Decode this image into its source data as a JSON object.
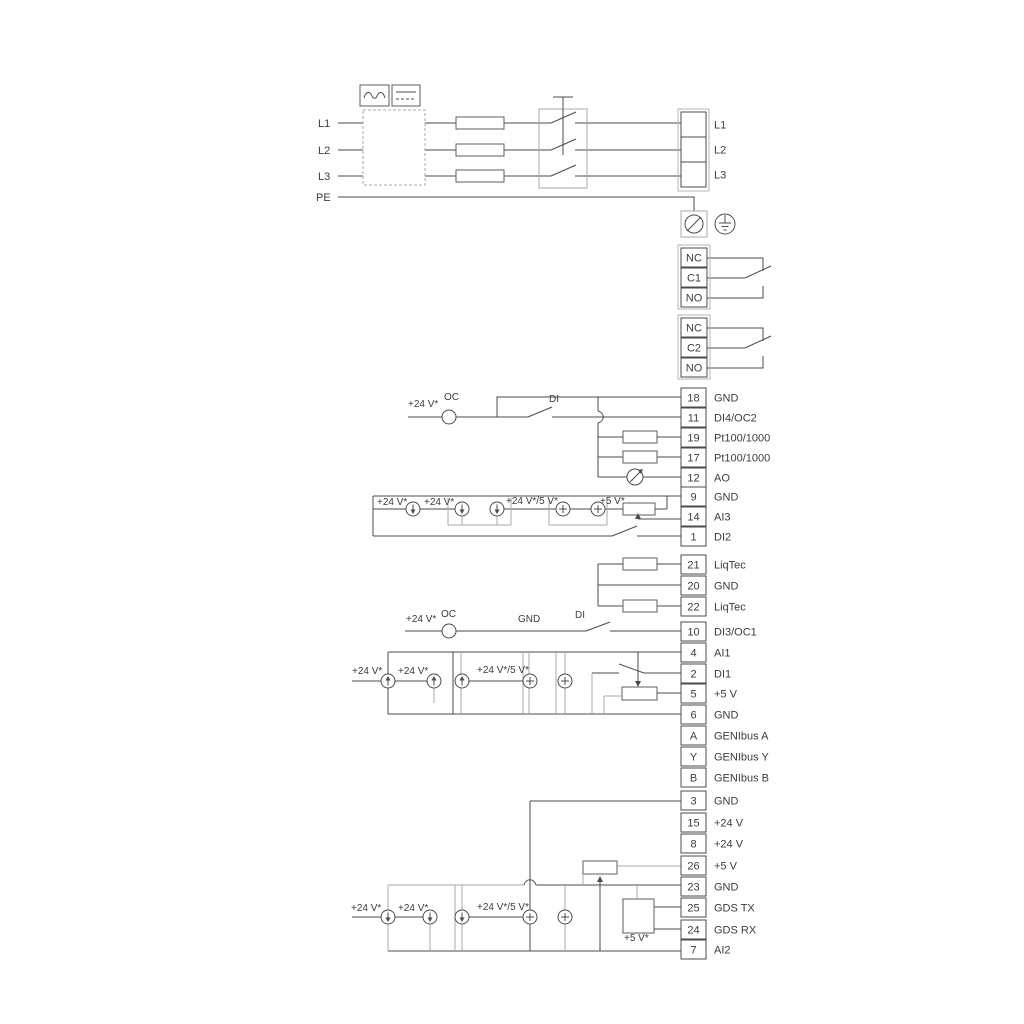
{
  "colors": {
    "wire": "#4b4b4b",
    "alt_wire": "#a8a8a8",
    "text": "#3c3c3c",
    "background": "#ffffff"
  },
  "power": {
    "left_labels": [
      {
        "t": "L1",
        "x": 318,
        "y": 127
      },
      {
        "t": "L2",
        "x": 318,
        "y": 154
      },
      {
        "t": "L3",
        "x": 318,
        "y": 180
      },
      {
        "t": "PE",
        "x": 316,
        "y": 201
      }
    ]
  },
  "terminal_groups": [
    {
      "name": "mains-out",
      "x": 681,
      "w": 25,
      "h": 25,
      "frame": [
        678,
        109,
        31,
        82
      ],
      "cells": [
        {
          "t": "L1",
          "top": 112
        },
        {
          "t": "L2",
          "top": 137
        },
        {
          "t": "L3",
          "top": 162
        }
      ]
    },
    {
      "name": "relay-1",
      "x": 681,
      "w": 26,
      "h": 19,
      "frame": [
        678,
        245,
        32,
        64
      ],
      "cells": [
        {
          "n": "NC",
          "top": 248
        },
        {
          "n": "C1",
          "top": 268
        },
        {
          "n": "NO",
          "top": 288
        }
      ]
    },
    {
      "name": "relay-2",
      "x": 681,
      "w": 26,
      "h": 19,
      "frame": [
        678,
        315,
        32,
        64
      ],
      "cells": [
        {
          "n": "NC",
          "top": 318
        },
        {
          "n": "C2",
          "top": 338
        },
        {
          "n": "NO",
          "top": 358
        }
      ]
    },
    {
      "name": "io-group-1",
      "x": 681,
      "w": 25,
      "h": 19,
      "cells": [
        {
          "n": "18",
          "t": "GND",
          "top": 388
        },
        {
          "n": "11",
          "t": "DI4/OC2",
          "top": 408
        },
        {
          "n": "19",
          "t": "Pt100/1000",
          "top": 428
        },
        {
          "n": "17",
          "t": "Pt100/1000",
          "top": 448
        },
        {
          "n": "12",
          "t": "AO",
          "top": 468
        },
        {
          "n": "9",
          "t": "GND",
          "top": 487
        },
        {
          "n": "14",
          "t": "AI3",
          "top": 507
        },
        {
          "n": "1",
          "t": "DI2",
          "top": 527
        }
      ]
    },
    {
      "name": "io-group-2",
      "x": 681,
      "w": 25,
      "h": 19,
      "cells": [
        {
          "n": "21",
          "t": "LiqTec",
          "top": 555
        },
        {
          "n": "20",
          "t": "GND",
          "top": 576
        },
        {
          "n": "22",
          "t": "LiqTec",
          "top": 597
        }
      ]
    },
    {
      "name": "io-group-3",
      "x": 681,
      "w": 25,
      "h": 19,
      "cells": [
        {
          "n": "10",
          "t": "DI3/OC1",
          "top": 622
        },
        {
          "n": "4",
          "t": "AI1",
          "top": 643
        },
        {
          "n": "2",
          "t": "DI1",
          "top": 664
        },
        {
          "n": "5",
          "t": "+5 V",
          "top": 684
        },
        {
          "n": "6",
          "t": "GND",
          "top": 705
        },
        {
          "n": "A",
          "t": "GENIbus A",
          "top": 726
        },
        {
          "n": "Y",
          "t": "GENIbus Y",
          "top": 747
        },
        {
          "n": "B",
          "t": "GENIbus B",
          "top": 768
        }
      ]
    },
    {
      "name": "io-group-4",
      "x": 681,
      "w": 25,
      "h": 19,
      "cells": [
        {
          "n": "3",
          "t": "GND",
          "top": 791
        },
        {
          "n": "15",
          "t": "+24 V",
          "top": 813
        },
        {
          "n": "8",
          "t": "+24 V",
          "top": 834
        },
        {
          "n": "26",
          "t": "+5 V",
          "top": 856
        },
        {
          "n": "23",
          "t": "GND",
          "top": 877
        },
        {
          "n": "25",
          "t": "GDS TX",
          "top": 898
        },
        {
          "n": "24",
          "t": "GDS RX",
          "top": 920
        },
        {
          "n": "7",
          "t": "AI2",
          "top": 940
        }
      ]
    }
  ],
  "annotations": [
    {
      "t": "+24 V*",
      "x": 408,
      "y": 407
    },
    {
      "t": "OC",
      "x": 444,
      "y": 400
    },
    {
      "t": "DI",
      "x": 549,
      "y": 402
    },
    {
      "t": "+24 V*",
      "x": 377,
      "y": 505
    },
    {
      "t": "+24 V*",
      "x": 424,
      "y": 505
    },
    {
      "t": "+24 V*/5 V*",
      "x": 506,
      "y": 504
    },
    {
      "t": "+5 V*",
      "x": 600,
      "y": 504
    },
    {
      "t": "+24 V*",
      "x": 406,
      "y": 622
    },
    {
      "t": "OC",
      "x": 441,
      "y": 617
    },
    {
      "t": "GND",
      "x": 518,
      "y": 622
    },
    {
      "t": "DI",
      "x": 575,
      "y": 618
    },
    {
      "t": "+24 V*",
      "x": 352,
      "y": 674
    },
    {
      "t": "+24 V*",
      "x": 398,
      "y": 674
    },
    {
      "t": "+24 V*/5 V*",
      "x": 477,
      "y": 673
    },
    {
      "t": "+24 V*",
      "x": 351,
      "y": 911
    },
    {
      "t": "+24 V*",
      "x": 398,
      "y": 911
    },
    {
      "t": "+24 V*/5 V*",
      "x": 477,
      "y": 910
    },
    {
      "t": "+5 V*",
      "x": 624,
      "y": 941
    }
  ]
}
